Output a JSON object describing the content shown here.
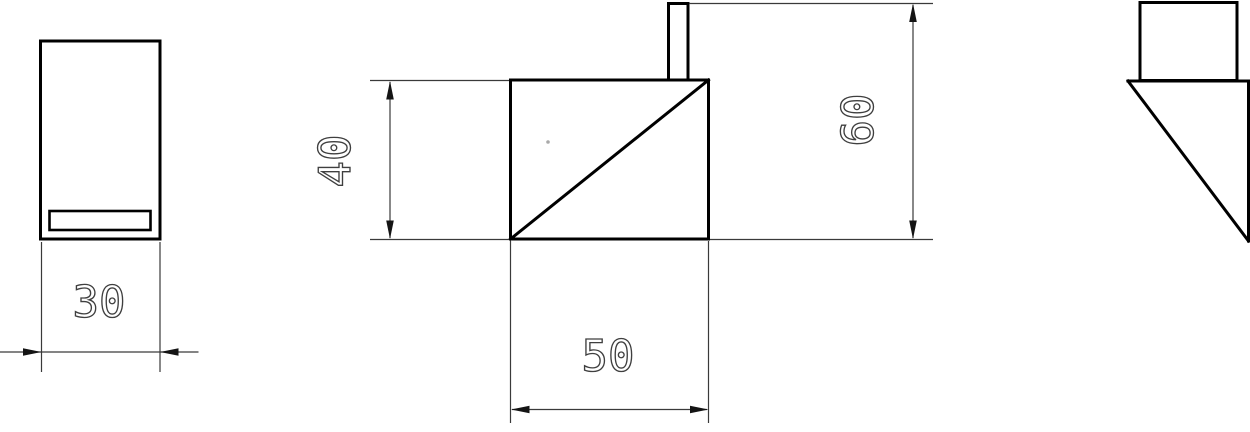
{
  "drawing": {
    "background_color": "#ffffff",
    "object_line_color": "#000000",
    "dimension_line_color": "#3a3a3a",
    "dimension_text_color": "#3f3f3f",
    "views": [
      {
        "id": "front-view",
        "shape": "tall rectangle with horizontal slot near bottom"
      },
      {
        "id": "side-view",
        "shape": "square with diagonal from bottom-left to top-right and small tab on top"
      },
      {
        "id": "iso-view",
        "shape": "rectangle above right triangle"
      }
    ],
    "dimensions": [
      {
        "id": "dim-30",
        "value": "30",
        "orientation": "horizontal",
        "view": "front-view"
      },
      {
        "id": "dim-40",
        "value": "40",
        "orientation": "vertical",
        "view": "side-view"
      },
      {
        "id": "dim-50",
        "value": "50",
        "orientation": "horizontal",
        "view": "side-view"
      },
      {
        "id": "dim-60",
        "value": "60",
        "orientation": "vertical",
        "view": "side-view"
      }
    ]
  }
}
